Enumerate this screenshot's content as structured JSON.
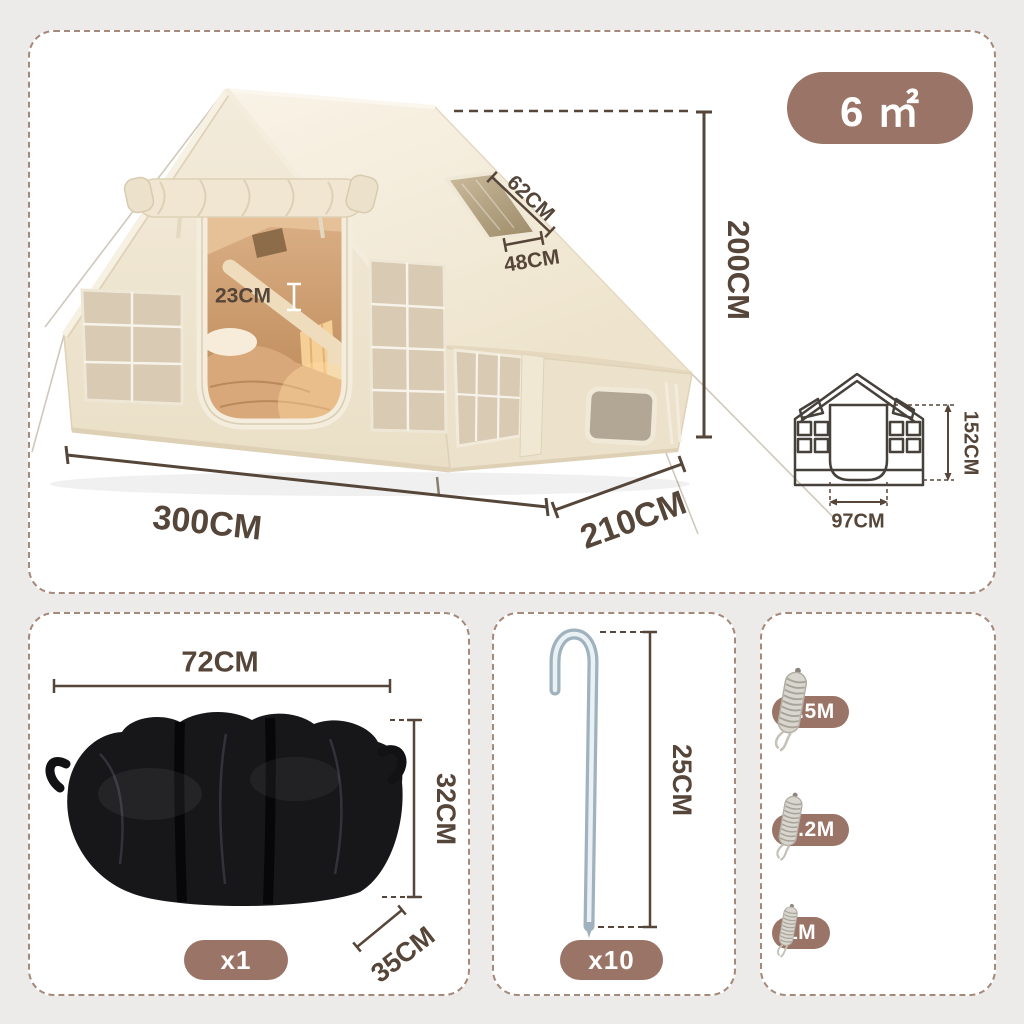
{
  "colors": {
    "background": "#ecebe9",
    "panel_bg": "#ffffff",
    "panel_border": "#a5897a",
    "accent": "#9a7467",
    "dimension": "#564639",
    "diagram_line": "#46413a",
    "tent_fabric": "#f1e8d6",
    "tent_roof": "#f7f1e3",
    "tent_mesh": "#d8cab3",
    "interior_warm": "#c89563",
    "bag_black": "#17171a",
    "stake_metal": "#9fb2bd",
    "rope_gray": "#d9d6cf"
  },
  "tent_panel": {
    "area_badge": "6 ㎡",
    "height_dim": "200CM",
    "width_dim": "300CM",
    "depth_dim": "210CM",
    "skylight_width_dim": "62CM",
    "skylight_height_dim": "48CM",
    "tube_dim": "23CM",
    "front_diagram": {
      "door_height_dim": "152CM",
      "door_width_dim": "97CM"
    }
  },
  "bag_panel": {
    "width_dim": "72CM",
    "height_dim": "32CM",
    "depth_dim": "35CM",
    "quantity": "x1"
  },
  "stake_panel": {
    "length_dim": "25CM",
    "quantity": "x10"
  },
  "rope_panel": {
    "rows": [
      {
        "label": "2.5M",
        "count": 2
      },
      {
        "label": "2.2M",
        "count": 4
      },
      {
        "label": "1M",
        "count": 4
      }
    ]
  }
}
